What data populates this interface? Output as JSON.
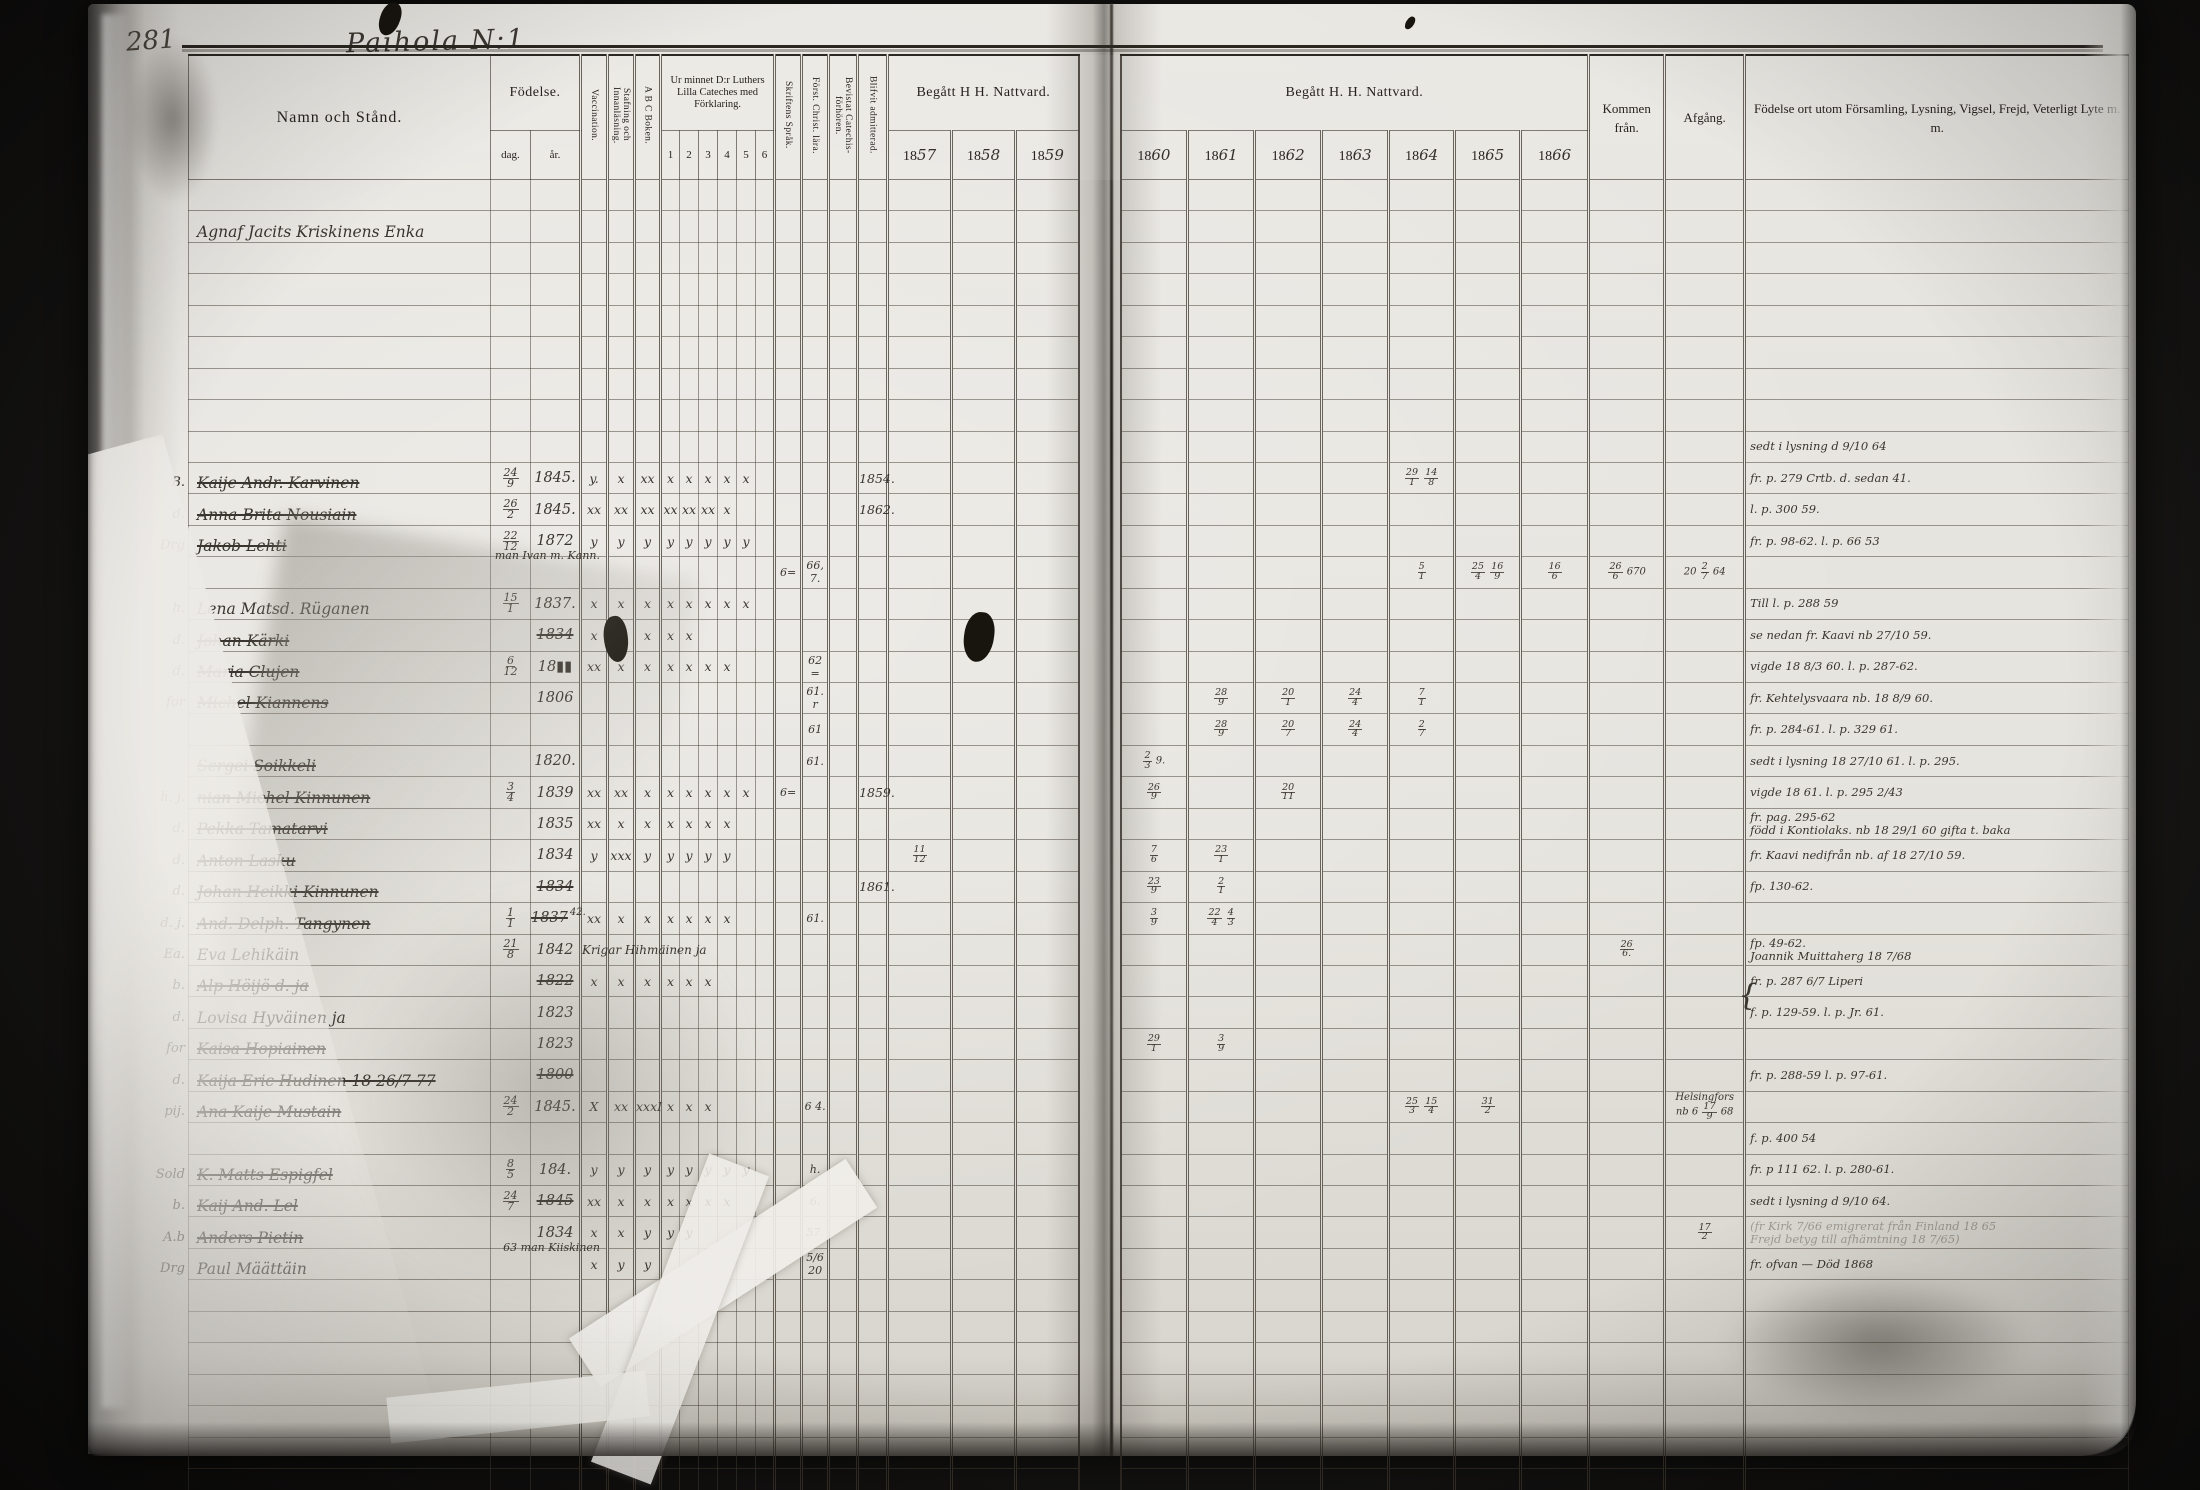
{
  "palette": {
    "photo_bg": "#141312",
    "paper": "#e6e4df",
    "print_ink": "#262220",
    "hand_ink": "#3a352f",
    "rule_line": "#4a4238"
  },
  "page": {
    "number": "281",
    "title": "Paihola N:1"
  },
  "header": {
    "name_col": "Namn och Stånd.",
    "fodelse": "Födelse.",
    "dag": "dag.",
    "ar": "år.",
    "vaccination": "Vaccination.",
    "stafning": "Stafning och Innanläsning.",
    "abc": "A B C Boken.",
    "cateches": "Ur minnet D:r Luthers Lilla Cateches med Förklaring.",
    "cat_numbers": [
      "1",
      "2",
      "3",
      "4",
      "5",
      "6"
    ],
    "sprak": "Skriftens Språk.",
    "christ": "Först. Christ. lära.",
    "bevistat": "Bevistat Catechis-förhören.",
    "admitted": "Blifvit admitterad.",
    "nattvard_left": "Begått H  H. Nattvard.",
    "nattvard_right": "Begått H. H. Nattvard.",
    "years_left": [
      {
        "printed": "18",
        "written": "57"
      },
      {
        "printed": "18",
        "written": "58"
      },
      {
        "printed": "18",
        "written": "59"
      }
    ],
    "years_right": [
      {
        "printed": "18",
        "written": "60"
      },
      {
        "printed": "18",
        "written": "61"
      },
      {
        "printed": "18",
        "written": "62"
      },
      {
        "printed": "18",
        "written": "63"
      },
      {
        "printed": "18",
        "written": "64"
      },
      {
        "printed": "18",
        "written": "65"
      },
      {
        "printed": "18",
        "written": "66"
      }
    ],
    "kommen": "Kommen från.",
    "afgang": "Afgång.",
    "remarks": "Födelse ort utom Församling, Lysning, Vigsel, Frejd, Veterligt Lyte m. m."
  },
  "table": {
    "row_count": 44,
    "rows": [
      {
        "i": 1,
        "name": "Agnaf Jacits Kriskinens Enka"
      },
      {
        "i": 8,
        "remark": [
          "sedt i lysning d 9/10 64"
        ]
      },
      {
        "i": 9,
        "pre": "B.",
        "name": "Kaije Andr. Karvinen",
        "struck": true,
        "dag": "24/9",
        "ar": "1845.",
        "marks": [
          "y.",
          "x",
          "xx",
          "x",
          "x",
          "x",
          "x",
          "x",
          ""
        ],
        "adm": "1854.",
        "c64": "29/1 14/8",
        "remark": [
          "fr. p. 279 Crtb. d. sedan 41."
        ]
      },
      {
        "i": 10,
        "pre": "d.",
        "name": "Anna Brita Nousiain",
        "struck": true,
        "dag": "26/2",
        "ar": "1845.",
        "marks": [
          "xx",
          "xx",
          "xx",
          "xx",
          "xx",
          "xx",
          "x",
          "",
          ""
        ],
        "adm": "1862.",
        "remark": [
          "l. p. 300 59."
        ]
      },
      {
        "i": 11,
        "pre": "Drg",
        "name": "Jakob Lehti",
        "struck": true,
        "note": "man Ivan m. Kann.",
        "dag": "22/12",
        "ar": "1872",
        "marks": [
          "y",
          "y",
          "y",
          "y",
          "y",
          "y",
          "y",
          "y",
          ""
        ],
        "remark": [
          "fr. p. 98-62.  l. p. 66 53"
        ]
      },
      {
        "i": 12,
        "sprak": "6=",
        "christ": "66, 7.",
        "c64": "5/1",
        "c65": "25/4 16/9",
        "c66": "16/6",
        "kommen": "26/6 670",
        "afgang": [
          "20 2/7 64"
        ]
      },
      {
        "i": 13,
        "pre": "h.",
        "name": "Lena Matsd. Rüganen",
        "dag": "15/1",
        "ar": "1837.",
        "marks": [
          "x",
          "x",
          "x",
          "x",
          "x",
          "x",
          "x",
          "x",
          ""
        ],
        "remark": [
          "Till l. p. 288 59"
        ]
      },
      {
        "i": 14,
        "pre": "d.",
        "name": "Johan Kärki",
        "struck": true,
        "ar": "1834",
        "ar_struck": true,
        "marks": [
          "x",
          "x",
          "x",
          "x",
          "x",
          "",
          "",
          "",
          ""
        ],
        "remark": [
          "se nedan fr. Kaavi nb 27/10 59."
        ]
      },
      {
        "i": 15,
        "pre": "d.",
        "name": "Maria Clujen",
        "struck": true,
        "dag": "6/12",
        "ar": "18▮▮",
        "marks": [
          "xx",
          "x",
          "x",
          "x",
          "x",
          "x",
          "x",
          "",
          ""
        ],
        "christ": "62 =",
        "remark": [
          "vigde 18 8/3 60.  l. p. 287-62."
        ]
      },
      {
        "i": 16,
        "pre": "for",
        "name": "Michel Kiannens",
        "struck": true,
        "ar": "1806",
        "christ": "61. r",
        "c61": "28/9",
        "c62": "20/1",
        "c63": "24/4",
        "c64": "7/1",
        "remark": [
          "fr. Kehtelysvaara nb. 18 8/9 60."
        ]
      },
      {
        "i": 17,
        "christ": "61",
        "c61": "28/9",
        "c62": "20/7",
        "c63": "24/4",
        "c64": "2/7",
        "remark": [
          "fr. p. 284-61.  l. p. 329 61."
        ]
      },
      {
        "i": 18,
        "name": "Sergei Soikkeli",
        "struck": true,
        "ar": "1820.",
        "christ": "61.",
        "c60": "2/3 9.",
        "remark": [
          "sedt i lysning 18 27/10 61. l. p. 295."
        ]
      },
      {
        "i": 19,
        "pre": "h. j.",
        "name": "nian Michel Kinnunen",
        "struck": true,
        "dag": "3/4",
        "ar": "1839",
        "marks": [
          "xx",
          "xx",
          "x",
          "x",
          "x",
          "x",
          "x",
          "x",
          ""
        ],
        "sprak": "6=",
        "adm": "1859.",
        "c60": "26/9",
        "c62": "20/11",
        "remark": [
          "vigde 18 61.  l. p. 295 2/43"
        ]
      },
      {
        "i": 20,
        "pre": "d.",
        "name": "Pekka Tamatarvi",
        "struck": true,
        "ar": "1835",
        "marks": [
          "xx",
          "x",
          "x",
          "x",
          "x",
          "x",
          "x",
          "",
          ""
        ],
        "remark": [
          "fr. pag. 295-62",
          "född i Kontiolaks. nb 18 29/1 60 gifta t. baka"
        ]
      },
      {
        "i": 21,
        "pre": "d.",
        "name": "Anton Lasku",
        "struck": true,
        "ar": "1834",
        "marks": [
          "y",
          "xxx",
          "y",
          "y",
          "y",
          "y",
          "y",
          "",
          ""
        ],
        "c57": "11/12",
        "c60": "7/6",
        "c61": "23/1",
        "remark": [
          "fr. Kaavi nedifrån nb. af 18 27/10 59."
        ]
      },
      {
        "i": 22,
        "pre": "d.",
        "name": "Johan Heikki Kinnunen",
        "struck": true,
        "ar": "1834",
        "ar_struck": true,
        "adm": "1861.",
        "c60": "23/9",
        "c61": "2/1",
        "remark": [
          "fp. 130-62."
        ]
      },
      {
        "i": 23,
        "pre": "d. j.",
        "name": "And. Delph. Tangynen",
        "struck": true,
        "dag": "1/1",
        "ar": "1837",
        "ar_struck": true,
        "ar_note": "42.",
        "christ": "61.",
        "marks": [
          "xx",
          "x",
          "x",
          "x",
          "x",
          "x",
          "x",
          "",
          ""
        ],
        "c60": "3/9",
        "c61": "22/4 4/3"
      },
      {
        "i": 24,
        "pre": "Ea.",
        "name": "Eva Lehikäin",
        "dag": "21/8",
        "ar": "1842",
        "mnote": "Krigar Hihmäinen ja",
        "kommen": "26/6.",
        "remark": [
          "fp. 49-62.",
          "Joannik Muittaherg 18 7/68"
        ]
      },
      {
        "i": 25,
        "pre": "b.",
        "name": "Alp Höijö d. ja",
        "struck": true,
        "ar": "1822",
        "ar_struck": true,
        "marks": [
          "x",
          "x",
          "x",
          "x",
          "x",
          "x",
          "",
          "",
          ""
        ],
        "remark": [
          "fr. p. 287 6/7 Liperi"
        ]
      },
      {
        "i": 26,
        "pre": "d.",
        "name": "Lovisa Hyväinen ja",
        "ar": "1823",
        "brace": true,
        "remark": [
          "f. p. 129-59.  l. p. Jr. 61."
        ]
      },
      {
        "i": 27,
        "pre": "for",
        "name": "Kaisa Hopiainen",
        "struck": true,
        "ar": "1823",
        "c60": "29/1",
        "c61": "3/9"
      },
      {
        "i": 28,
        "pre": "d.",
        "name": "Kaija Eric Hudinen  18 26/7 77",
        "struck": true,
        "ar": "1800",
        "ar_struck": true,
        "remark": [
          "fr. p. 288-59  l. p. 97-61."
        ]
      },
      {
        "i": 29,
        "pre": "pij.",
        "name": "Ana Kaije Mustain",
        "struck": true,
        "dag": "24/2",
        "ar": "1845.",
        "marks": [
          "X",
          "xx",
          "xxxI",
          "x",
          "x",
          "x",
          "",
          "",
          ""
        ],
        "christ": "6 4.",
        "c64": "25/3 15/4",
        "c65": "31/2",
        "afgang": [
          "Helsingfors",
          "nb 6 17/9 68"
        ]
      },
      {
        "i": 30,
        "remark": [
          "f. p. 400 54"
        ]
      },
      {
        "i": 31,
        "pre": "Sold",
        "name": "K. Matts Espigfel",
        "struck": true,
        "dag": "8/5",
        "ar": "184.",
        "marks": [
          "y",
          "y",
          "y",
          "y",
          "y",
          "y",
          "y",
          "y",
          ""
        ],
        "christ": "h.",
        "remark": [
          "fr. p 111 62.  l. p. 280-61."
        ]
      },
      {
        "i": 32,
        "pre": "b.",
        "name": "Kaij And. Lel",
        "struck": true,
        "dag": "24/7",
        "ar": "1845",
        "ar_struck": true,
        "marks": [
          "xx",
          "x",
          "x",
          "x",
          "x",
          "x",
          "x",
          "",
          ""
        ],
        "christ": "6.",
        "remark": [
          "sedt i lysning d 9/10 64."
        ]
      },
      {
        "i": 33,
        "pre": "A.b",
        "name": "Anders Pietin",
        "struck": true,
        "note": "63   man Kiiskinen",
        "ar": "1834",
        "marks": [
          "x",
          "x",
          "y",
          "y",
          "y",
          "",
          "",
          "",
          ""
        ],
        "christ": "57.",
        "afgang": [
          "17/2"
        ],
        "remark_faint": true,
        "remark": [
          "(fr Kirk 7/66 emigrerat från Finland 18 65",
          "Frejd betyg till afhämtning 18 7/65)"
        ]
      },
      {
        "i": 34,
        "pre": "Drg",
        "name": "Paul Määttäin",
        "marks": [
          "x",
          "y",
          "y",
          "",
          "",
          "",
          "",
          "",
          ""
        ],
        "christ": "5/6 20",
        "remark": [
          "fr. ofvan —  Död 1868"
        ]
      },
      {
        "i": 42,
        "pre": "d.",
        "name": "Johan Leppäinen",
        "struck": true,
        "ar": "1830"
      },
      {
        "i": 43,
        "c58": "17/6 26/12",
        "remark_faint": true,
        "remark": [
          "58 f. p. 9 S ..."
        ]
      }
    ]
  }
}
